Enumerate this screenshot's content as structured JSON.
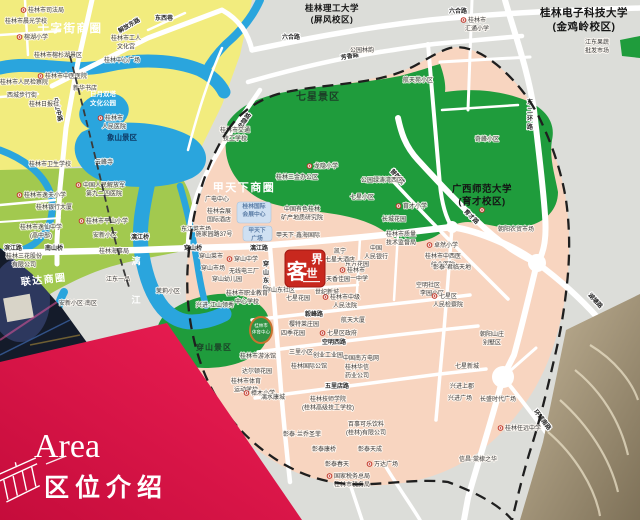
{
  "banner": {
    "title_en": "Area",
    "title_zh": "区位介绍"
  },
  "logo": {
    "name": "客世界",
    "chars": [
      "客",
      "世",
      "界"
    ]
  },
  "colors": {
    "banner_red": "#e3164a",
    "logo_red": "#c8281e",
    "zone_pink": "#f8d5c0",
    "park_green": "#1f9c3c",
    "west_green": "#a2c94f",
    "river_blue": "#2aa5dd",
    "district_yellow": "#f2ec7e",
    "outside_gray": "#dcddd9"
  },
  "photos": {
    "bottom_left": "night-street-photo",
    "bottom_right": "rooftop-aerial-photo"
  },
  "markers": [
    [
      482,
      210
    ]
  ],
  "labels": {
    "big": [
      {
        "lines": [
          "十字街商圈"
        ],
        "x": 70,
        "y": 32,
        "cls": "bw",
        "s": 11.5
      },
      {
        "lines": [
          "甲天下商圈"
        ],
        "x": 244,
        "y": 191,
        "cls": "bw",
        "s": 11
      },
      {
        "lines": [
          "联达商圈"
        ],
        "x": 44,
        "y": 283,
        "cls": "bw",
        "s": 10,
        "rot": -6
      },
      {
        "lines": [
          "七星景区"
        ],
        "x": 318,
        "y": 100,
        "cls": "sc",
        "s": 10
      },
      {
        "lines": [
          "穿山景区"
        ],
        "x": 214,
        "y": 350,
        "cls": "sc",
        "s": 8
      },
      {
        "lines": [
          "桂林理工大学",
          "(屏风校区)"
        ],
        "x": 332,
        "y": 11,
        "cls": "bb",
        "s": 8.5
      },
      {
        "lines": [
          "桂林电子科技大学",
          "(金鸡岭校区)"
        ],
        "x": 584,
        "y": 16,
        "cls": "bb",
        "s": 10.5
      },
      {
        "lines": [
          "广西师范大学",
          "(育才校区)"
        ],
        "x": 482,
        "y": 192,
        "cls": "bb",
        "s": 9.5
      },
      {
        "lines": [
          "象山景区"
        ],
        "x": 122,
        "y": 140,
        "cls": "sc2",
        "s": 7.5
      },
      {
        "lines": [
          "日月双塔",
          "文化公园"
        ],
        "x": 103,
        "y": 96,
        "cls": "wt",
        "s": 6.5
      },
      {
        "lines": [
          "漓"
        ],
        "x": 136,
        "y": 264,
        "cls": "wt",
        "s": 9
      },
      {
        "lines": [
          "江"
        ],
        "x": 136,
        "y": 303,
        "cls": "wt",
        "s": 9
      },
      {
        "lines": [
          "桂林市",
          "体育中心"
        ],
        "x": 261,
        "y": 327,
        "cls": "pk",
        "s": 4.5
      }
    ],
    "roads": [
      {
        "lines": [
          "解放东路"
        ],
        "x": 130,
        "y": 27,
        "cls": "rd",
        "rot": -30
      },
      {
        "lines": [
          "东西巷"
        ],
        "x": 164,
        "y": 20,
        "cls": "rd"
      },
      {
        "lines": [
          "六合路"
        ],
        "x": 291,
        "y": 39,
        "cls": "rd"
      },
      {
        "lines": [
          "六合路"
        ],
        "x": 458,
        "y": 13,
        "cls": "rd"
      },
      {
        "lines": [
          "芳香路"
        ],
        "x": 350,
        "y": 58,
        "cls": "rd",
        "rot": -10
      },
      {
        "lines": [
          "龙隐路"
        ],
        "x": 246,
        "y": 122,
        "cls": "rd",
        "rot": -55
      },
      {
        "lines": [
          "东",
          "二",
          "环",
          "路"
        ],
        "x": 530,
        "y": 104,
        "cls": "rd"
      },
      {
        "lines": [
          "漓江路"
        ],
        "x": 259,
        "y": 250,
        "cls": "rd"
      },
      {
        "lines": [
          "滨江路"
        ],
        "x": 13,
        "y": 250,
        "cls": "rd"
      },
      {
        "lines": [
          "南山桥"
        ],
        "x": 54,
        "y": 250,
        "cls": "rd"
      },
      {
        "lines": [
          "漓江桥"
        ],
        "x": 140,
        "y": 239,
        "cls": "rd"
      },
      {
        "lines": [
          "穿山桥"
        ],
        "x": 193,
        "y": 250,
        "cls": "rd"
      },
      {
        "lines": [
          "中山中路"
        ],
        "x": 56,
        "y": 110,
        "cls": "rd",
        "rot": 78
      },
      {
        "lines": [
          "普陀路"
        ],
        "x": 396,
        "y": 178,
        "cls": "rd",
        "rot": 48
      },
      {
        "lines": [
          "育才路"
        ],
        "x": 470,
        "y": 218,
        "cls": "rd",
        "rot": 45
      },
      {
        "lines": [
          "毅峰路"
        ],
        "x": 314,
        "y": 316,
        "cls": "rd"
      },
      {
        "lines": [
          "空明西路"
        ],
        "x": 334,
        "y": 344,
        "cls": "rd"
      },
      {
        "lines": [
          "五里店路"
        ],
        "x": 337,
        "y": 388,
        "cls": "rd"
      },
      {
        "lines": [
          "湖塘路"
        ],
        "x": 594,
        "y": 302,
        "cls": "rd",
        "rot": 47
      },
      {
        "lines": [
          "环城南路"
        ],
        "x": 541,
        "y": 421,
        "cls": "rd",
        "rot": 52
      },
      {
        "lines": [
          "穿",
          "山",
          "东",
          "路"
        ],
        "x": 266,
        "y": 266,
        "cls": "rd"
      }
    ],
    "landmarks": [
      {
        "lines": [
          "桂林国际",
          "会展中心"
        ],
        "x": 254,
        "y": 208,
        "cls": "blu",
        "s": 5.8
      },
      {
        "lines": [
          "甲天下",
          "广场"
        ],
        "x": 257,
        "y": 232,
        "cls": "blu",
        "s": 5.8
      }
    ],
    "pois": [
      {
        "lines": [
          "桂林市司法局"
        ],
        "x": 46,
        "y": 12,
        "m": 1
      },
      {
        "lines": [
          "桂林市晨光学校"
        ],
        "x": 26,
        "y": 23
      },
      {
        "lines": [
          "榕湖小学"
        ],
        "x": 36,
        "y": 39,
        "m": 1
      },
      {
        "lines": [
          "桂林市工人",
          "文化宫"
        ],
        "x": 126,
        "y": 40
      },
      {
        "lines": [
          "桂林中心广场"
        ],
        "x": 122,
        "y": 62
      },
      {
        "lines": [
          "桂林市榕杉湖景区"
        ],
        "x": 58,
        "y": 57
      },
      {
        "lines": [
          "桂林市人民检察院"
        ],
        "x": 24,
        "y": 84
      },
      {
        "lines": [
          "桂林市中医医院"
        ],
        "x": 66,
        "y": 78,
        "m": 1
      },
      {
        "lines": [
          "新华书店"
        ],
        "x": 85,
        "y": 90
      },
      {
        "lines": [
          "西城步行街"
        ],
        "x": 22,
        "y": 97
      },
      {
        "lines": [
          "桂林日报社"
        ],
        "x": 44,
        "y": 106
      },
      {
        "lines": [
          "桂林市",
          "人民医院"
        ],
        "x": 114,
        "y": 120,
        "m": 1
      },
      {
        "lines": [
          "桂林市卫生学校"
        ],
        "x": 50,
        "y": 166
      },
      {
        "lines": [
          "云峰寺"
        ],
        "x": 104,
        "y": 164
      },
      {
        "lines": [
          "桂林市逸夫小学"
        ],
        "x": 45,
        "y": 197,
        "m": 1
      },
      {
        "lines": [
          "桂林银行大厦"
        ],
        "x": 54,
        "y": 209
      },
      {
        "lines": [
          "中国人民解放军",
          "第九二四医院"
        ],
        "x": 104,
        "y": 187,
        "m": 1
      },
      {
        "lines": [
          "桂林市逸仙中学",
          "(高中部)"
        ],
        "x": 41,
        "y": 229
      },
      {
        "lines": [
          "桂林市平山小学"
        ],
        "x": 107,
        "y": 223,
        "m": 1
      },
      {
        "lines": [
          "安新小区"
        ],
        "x": 105,
        "y": 237
      },
      {
        "lines": [
          "桂林海事局"
        ],
        "x": 114,
        "y": 253
      },
      {
        "lines": [
          "桂林三花股份",
          "有限公司"
        ],
        "x": 24,
        "y": 258
      },
      {
        "lines": [
          "江东一品"
        ],
        "x": 118,
        "y": 281
      },
      {
        "lines": [
          "安新小区·南区"
        ],
        "x": 78,
        "y": 305
      },
      {
        "lines": [
          "桂林市交通",
          "技工学校"
        ],
        "x": 235,
        "y": 132
      },
      {
        "lines": [
          "龙隐小学"
        ],
        "x": 326,
        "y": 168,
        "m": 1
      },
      {
        "lines": [
          "公园林韵"
        ],
        "x": 362,
        "y": 52
      },
      {
        "lines": [
          "航天苑小区"
        ],
        "x": 418,
        "y": 82
      },
      {
        "lines": [
          "桂林市",
          "汇通小学"
        ],
        "x": 477,
        "y": 22,
        "m": 1
      },
      {
        "lines": [
          "江东果蔬",
          "批发市场"
        ],
        "x": 597,
        "y": 44
      },
      {
        "lines": [
          "奇峰小区"
        ],
        "x": 487,
        "y": 141
      },
      {
        "lines": [
          "桂林三金办公区"
        ],
        "x": 297,
        "y": 179
      },
      {
        "lines": [
          "广电中心"
        ],
        "x": 217,
        "y": 201
      },
      {
        "lines": [
          "桂林会展",
          "国际酒店"
        ],
        "x": 219,
        "y": 213
      },
      {
        "lines": [
          "东江菜市场"
        ],
        "x": 196,
        "y": 231
      },
      {
        "lines": [
          "施家园路37号"
        ],
        "x": 214,
        "y": 236
      },
      {
        "lines": [
          "中国有色桂林",
          "矿产地质研究院"
        ],
        "x": 302,
        "y": 211
      },
      {
        "lines": [
          "甲天下·鑫海国际"
        ],
        "x": 298,
        "y": 237
      },
      {
        "lines": [
          "穿山菜市"
        ],
        "x": 211,
        "y": 258
      },
      {
        "lines": [
          "穿山中学"
        ],
        "x": 246,
        "y": 261,
        "m": 1
      },
      {
        "lines": [
          "穿山市场"
        ],
        "x": 213,
        "y": 270
      },
      {
        "lines": [
          "无线电三厂"
        ],
        "x": 244,
        "y": 273
      },
      {
        "lines": [
          "穿山幼儿园"
        ],
        "x": 227,
        "y": 281
      },
      {
        "lines": [
          "茉莉小区"
        ],
        "x": 168,
        "y": 293
      },
      {
        "lines": [
          "七星小区"
        ],
        "x": 362,
        "y": 199
      },
      {
        "lines": [
          "公园绿涛湾西区"
        ],
        "x": 382,
        "y": 182
      },
      {
        "lines": [
          "育才小学"
        ],
        "x": 415,
        "y": 208,
        "m": 1
      },
      {
        "lines": [
          "长城花园"
        ],
        "x": 394,
        "y": 221
      },
      {
        "lines": [
          "桂林市质量",
          "技术监督局"
        ],
        "x": 401,
        "y": 236
      },
      {
        "lines": [
          "朝阳农贸市场"
        ],
        "x": 516,
        "y": 231
      },
      {
        "lines": [
          "卓然小学"
        ],
        "x": 446,
        "y": 247,
        "m": 1
      },
      {
        "lines": [
          "桂林市中西医",
          "结合医院"
        ],
        "x": 443,
        "y": 258
      },
      {
        "lines": [
          "东方花园"
        ],
        "x": 357,
        "y": 266
      },
      {
        "lines": [
          "中国",
          "人民银行"
        ],
        "x": 376,
        "y": 250
      },
      {
        "lines": [
          "桂林市",
          "第一中学"
        ],
        "x": 356,
        "y": 272,
        "m": 1
      },
      {
        "lines": [
          "彰泰·君临天地"
        ],
        "x": 452,
        "y": 269
      },
      {
        "lines": [
          "空明社区"
        ],
        "x": 428,
        "y": 287
      },
      {
        "lines": [
          "李园小区"
        ],
        "x": 432,
        "y": 295
      },
      {
        "lines": [
          "七星区",
          "人民检察院"
        ],
        "x": 448,
        "y": 298,
        "m": 1
      },
      {
        "lines": [
          "凯宁",
          "七星大酒店"
        ],
        "x": 340,
        "y": 253
      },
      {
        "lines": [
          "天香佳园"
        ],
        "x": 338,
        "y": 281
      },
      {
        "lines": [
          "世纪新城"
        ],
        "x": 327,
        "y": 294
      },
      {
        "lines": [
          "桂林市中级",
          "人民法院"
        ],
        "x": 345,
        "y": 299,
        "m": 1
      },
      {
        "lines": [
          "穿山东社区"
        ],
        "x": 280,
        "y": 292
      },
      {
        "lines": [
          "七星花园"
        ],
        "x": 298,
        "y": 300
      },
      {
        "lines": [
          "樱特莱庄园"
        ],
        "x": 304,
        "y": 326
      },
      {
        "lines": [
          "航天大厦"
        ],
        "x": 353,
        "y": 322
      },
      {
        "lines": [
          "七星区政府"
        ],
        "x": 342,
        "y": 335,
        "m": 1
      },
      {
        "lines": [
          "四季花园"
        ],
        "x": 293,
        "y": 335
      },
      {
        "lines": [
          "三里小区"
        ],
        "x": 301,
        "y": 354
      },
      {
        "lines": [
          "创业工业园"
        ],
        "x": 328,
        "y": 357
      },
      {
        "lines": [
          "中国南方电网"
        ],
        "x": 361,
        "y": 360
      },
      {
        "lines": [
          "桂林国际公馆"
        ],
        "x": 309,
        "y": 368
      },
      {
        "lines": [
          "桂林华信",
          "药业公司"
        ],
        "x": 357,
        "y": 369
      },
      {
        "lines": [
          "桂林市游泳馆"
        ],
        "x": 258,
        "y": 358
      },
      {
        "lines": [
          "达尔顿花园"
        ],
        "x": 257,
        "y": 373
      },
      {
        "lines": [
          "桂林市体育",
          "运动学校"
        ],
        "x": 246,
        "y": 383
      },
      {
        "lines": [
          "樟木小学"
        ],
        "x": 263,
        "y": 395,
        "m": 1
      },
      {
        "lines": [
          "漓水康城"
        ],
        "x": 273,
        "y": 399
      },
      {
        "lines": [
          "桂林技师学院",
          "(桂林高级技工学校)"
        ],
        "x": 328,
        "y": 401
      },
      {
        "lines": [
          "百事可乐饮料",
          "(桂林)有限公司"
        ],
        "x": 366,
        "y": 426
      },
      {
        "lines": [
          "彰泰·兰乔圣菲"
        ],
        "x": 302,
        "y": 436
      },
      {
        "lines": [
          "彰泰康桥"
        ],
        "x": 324,
        "y": 451
      },
      {
        "lines": [
          "彰泰春天"
        ],
        "x": 337,
        "y": 466
      },
      {
        "lines": [
          "彰泰天成"
        ],
        "x": 370,
        "y": 451
      },
      {
        "lines": [
          "万达广场"
        ],
        "x": 386,
        "y": 466,
        "m": 1
      },
      {
        "lines": [
          "国家税务总局",
          "桂林市税务局"
        ],
        "x": 352,
        "y": 478,
        "m": 1
      },
      {
        "lines": [
          "朝阳山庄",
          "别墅区"
        ],
        "x": 492,
        "y": 336
      },
      {
        "lines": [
          "七星新城"
        ],
        "x": 467,
        "y": 368
      },
      {
        "lines": [
          "兴进上郡"
        ],
        "x": 462,
        "y": 388
      },
      {
        "lines": [
          "兴进广场"
        ],
        "x": 460,
        "y": 400
      },
      {
        "lines": [
          "长盛时代广场"
        ],
        "x": 498,
        "y": 401
      },
      {
        "lines": [
          "桂林任远中学"
        ],
        "x": 523,
        "y": 430,
        "m": 1
      },
      {
        "lines": [
          "信昌·棠棣之华"
        ],
        "x": 478,
        "y": 461
      },
      {
        "lines": [
          "桂林市职业教育",
          "中心学校"
        ],
        "x": 247,
        "y": 295
      },
      {
        "lines": [
          "兴进·江山领秀"
        ],
        "x": 215,
        "y": 307
      }
    ]
  }
}
